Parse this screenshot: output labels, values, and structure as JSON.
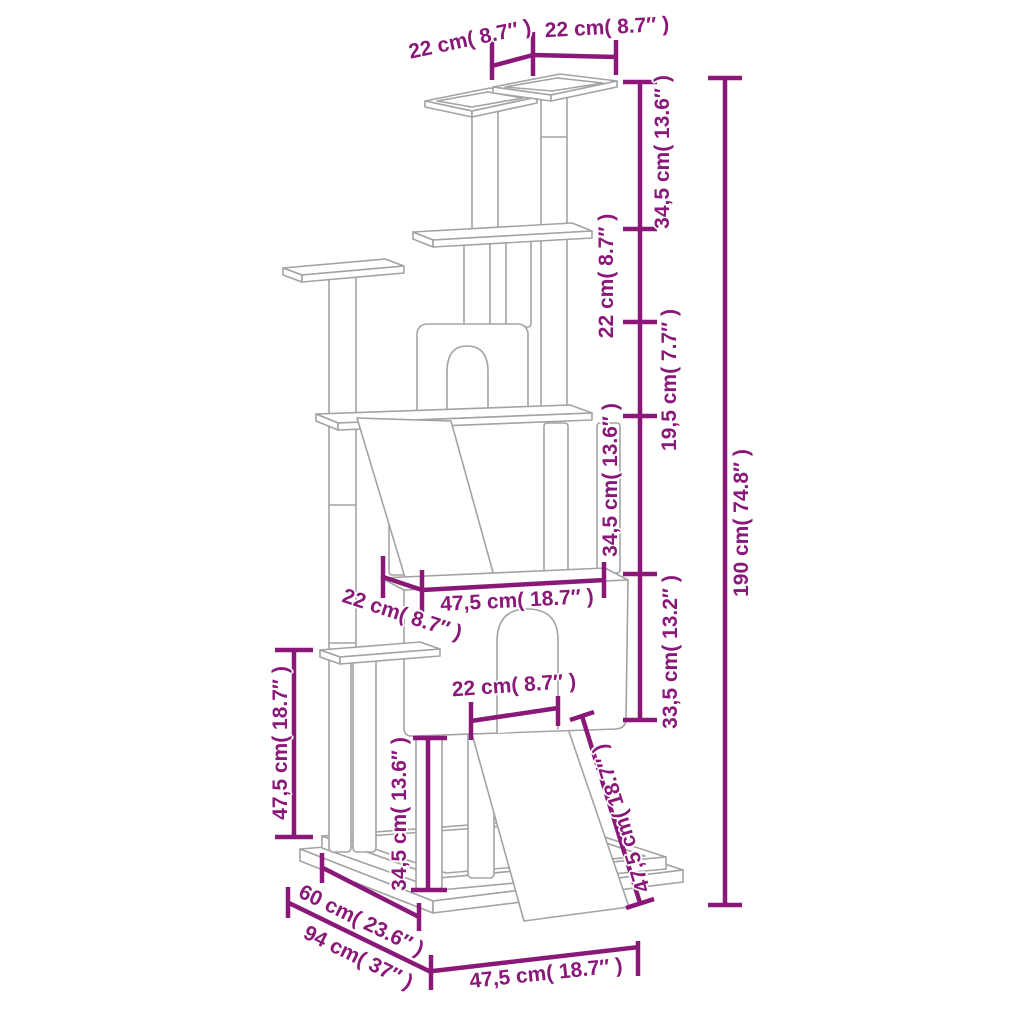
{
  "diagram": {
    "title": "cat-tree-dimension-diagram",
    "accent_color": "#8a1878",
    "outline_color": "#a3a3a3",
    "labels": {
      "top_platform_left_width": "22 cm( 8.7″ )",
      "top_platform_right_width": "22 cm( 8.7″ )",
      "height_segment_1": "34,5 cm( 13.6″ )",
      "height_segment_2": "22 cm( 8.7″ )",
      "height_segment_3": "19,5 cm( 7.7″ )",
      "height_segment_4": "34,5 cm( 13.6″ )",
      "height_segment_5": "33,5 cm( 13.2″ )",
      "total_height": "190 cm( 74.8″ )",
      "condo_depth": "22 cm( 8.7″ )",
      "condo_width": "47,5 cm( 18.7″ )",
      "door_width": "22 cm( 8.7″ )",
      "left_post_height": "47,5 cm( 18.7″ )",
      "front_post_height": "34,5 cm( 13.6″ )",
      "ramp_length": "47,5 cm( 18.7″ )",
      "base_depth_top": "60 cm( 23.6″ )",
      "base_depth_total": "94 cm( 37″ )",
      "base_width": "47,5 cm( 18.7″ )"
    }
  }
}
